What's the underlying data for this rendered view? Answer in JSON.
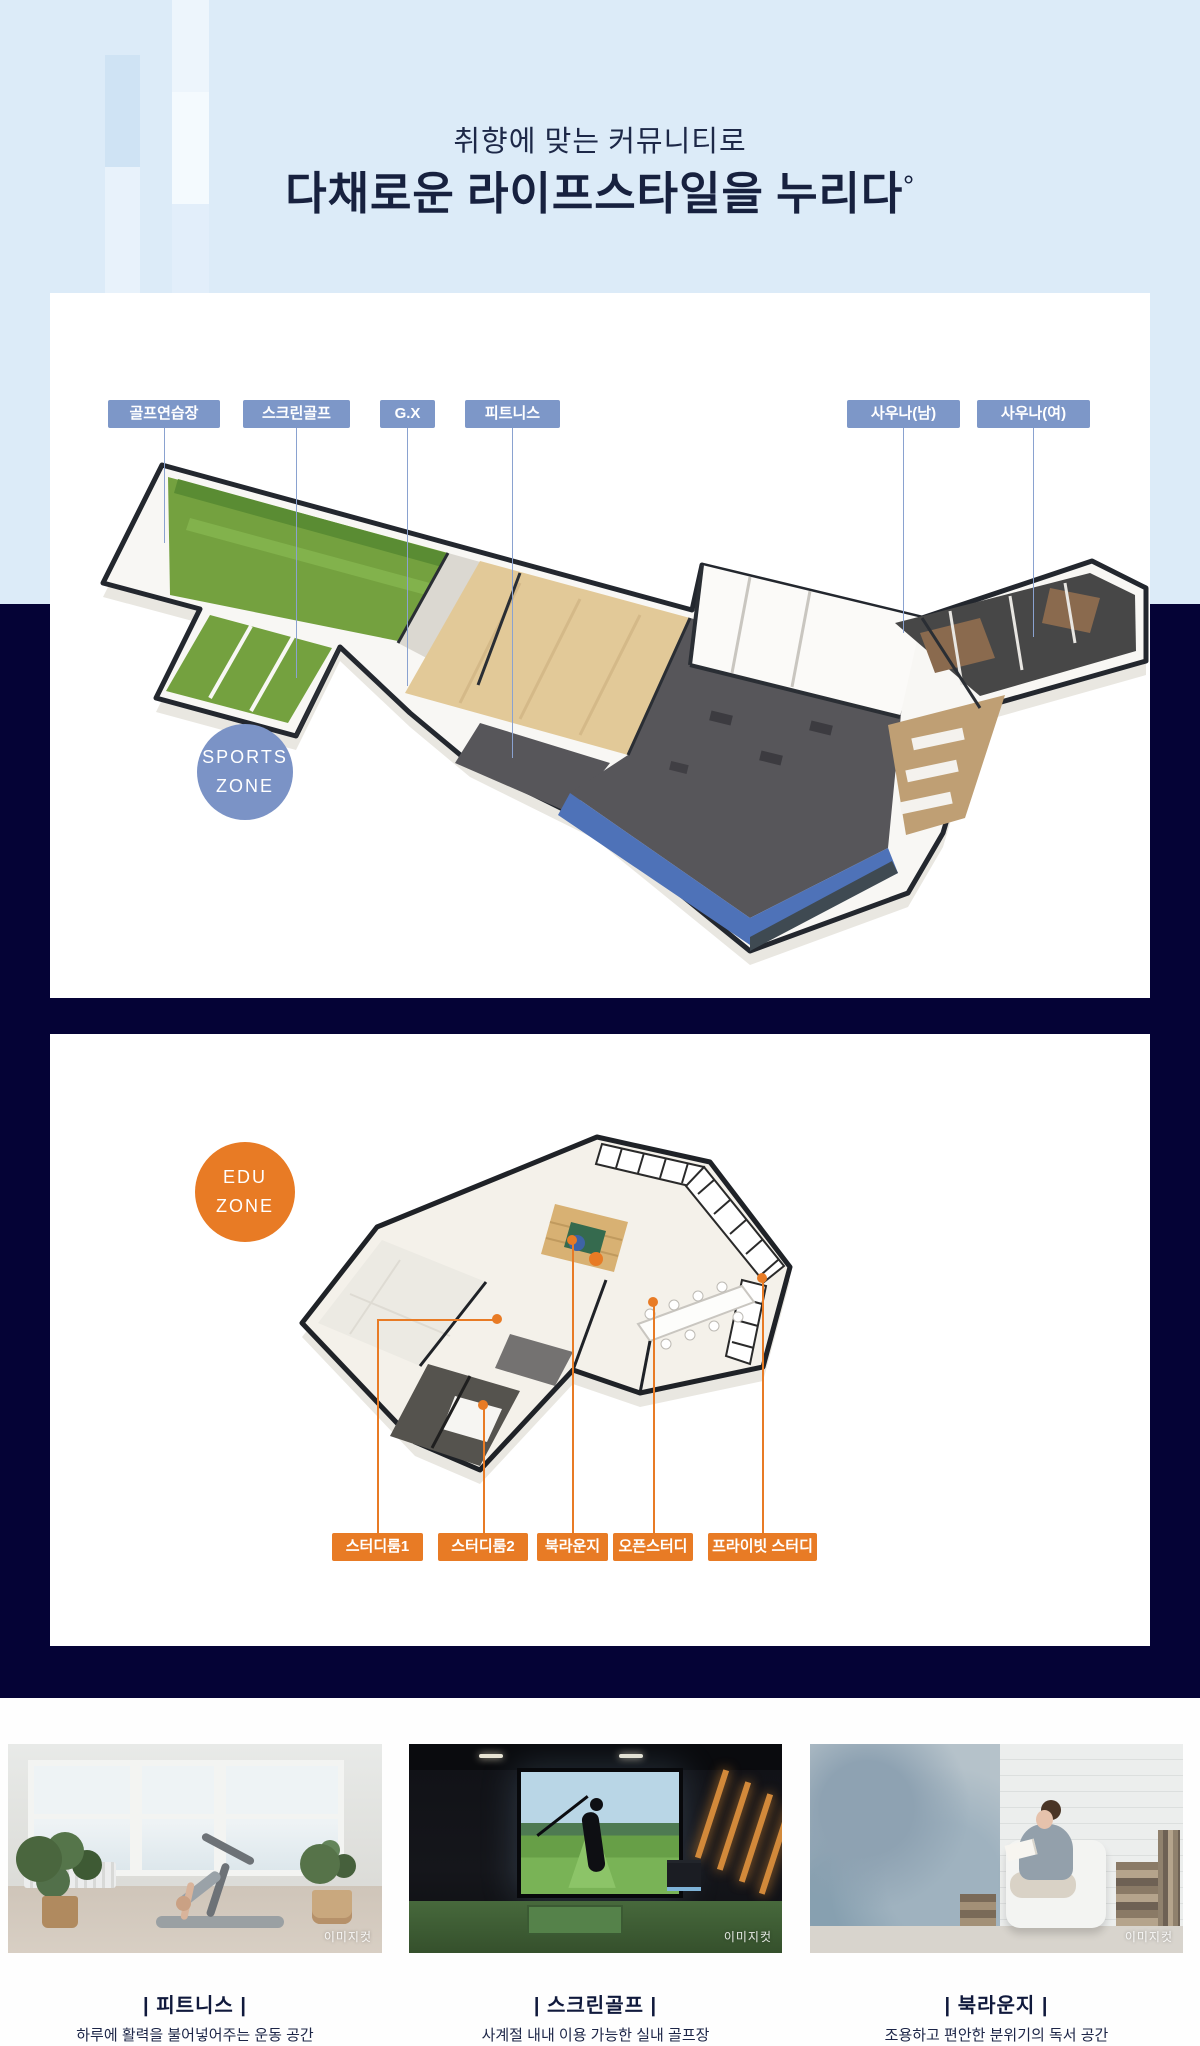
{
  "header": {
    "subtitle": "취향에 맞는 커뮤니티로",
    "title": "다채로운 라이프스타일을 누리다",
    "title_mark": "°"
  },
  "colors": {
    "light_blue_bg": "#dcebf8",
    "navy_bg": "#050336",
    "sports_accent": "#7d97c8",
    "edu_accent": "#e87b25"
  },
  "sports_zone": {
    "badge_line1": "SPORTS",
    "badge_line2": "ZONE",
    "labels": [
      {
        "text": "골프연습장"
      },
      {
        "text": "스크린골프"
      },
      {
        "text": "G.X"
      },
      {
        "text": "피트니스"
      },
      {
        "text": "사우나(남)"
      },
      {
        "text": "사우나(여)"
      }
    ]
  },
  "edu_zone": {
    "badge_line1": "EDU",
    "badge_line2": "ZONE",
    "labels": [
      {
        "text": "스터디룸1"
      },
      {
        "text": "스터디룸2"
      },
      {
        "text": "북라운지"
      },
      {
        "text": "오픈스터디"
      },
      {
        "text": "프라이빗 스터디"
      }
    ]
  },
  "cards": [
    {
      "title": "| 피트니스 |",
      "description": "하루에 활력을 불어넣어주는 운동 공간",
      "watermark": "이미지컷"
    },
    {
      "title": "| 스크린골프 |",
      "description": "사계절 내내 이용 가능한 실내 골프장",
      "watermark": "이미지컷"
    },
    {
      "title": "| 북라운지 |",
      "description": "조용하고 편안한 분위기의 독서 공간",
      "watermark": "이미지컷"
    }
  ]
}
